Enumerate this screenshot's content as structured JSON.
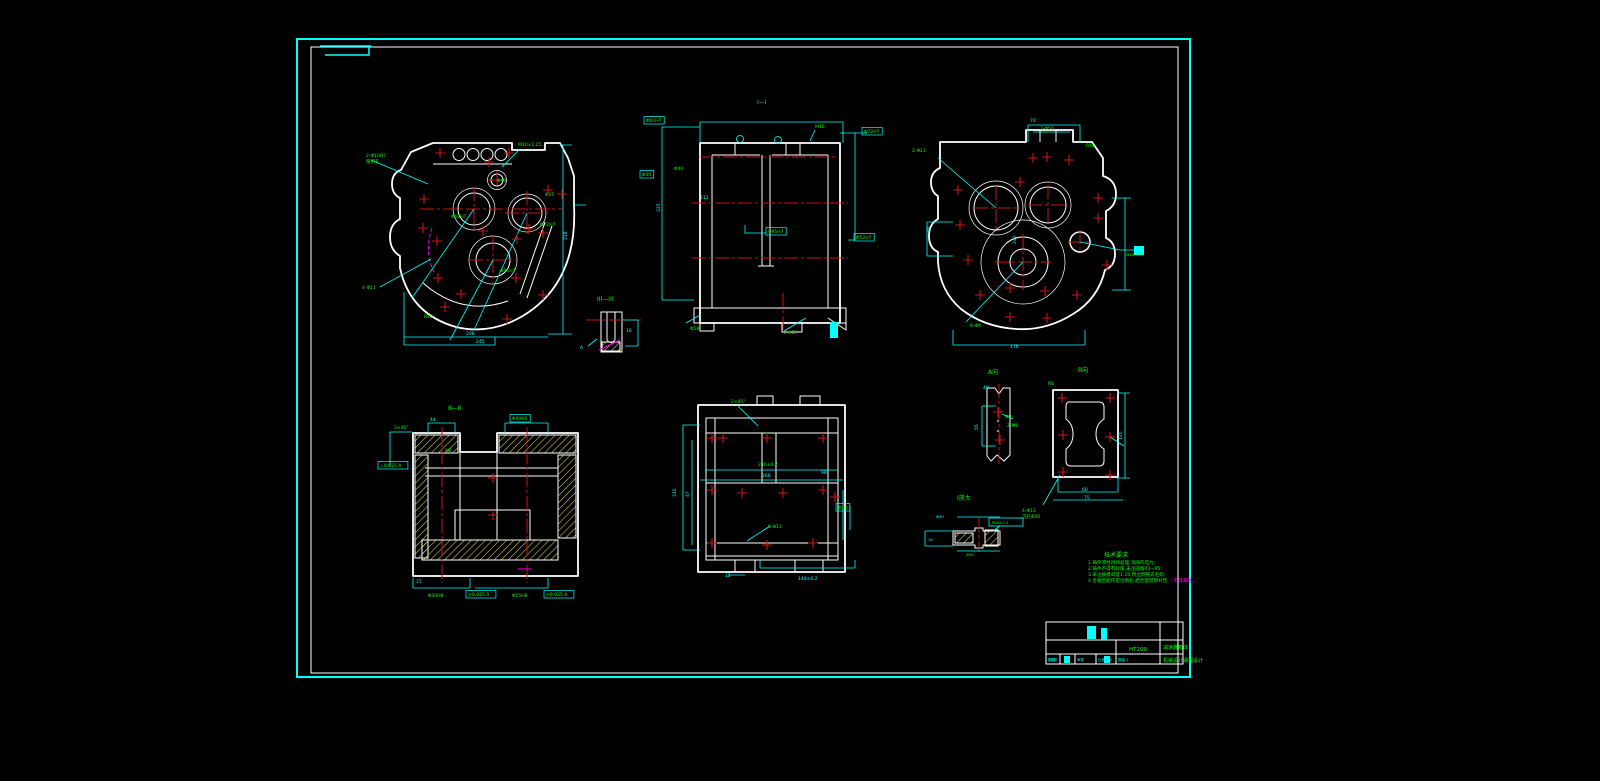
{
  "palette": {
    "background": "#000000",
    "frame_cyan": "#00ffff",
    "geometry_white": "#ffffff",
    "centerline_red": "#c81414",
    "dimension_cyan": "#00ffff",
    "label_green": "#00ff00",
    "hatch_yellow": "#ddd75a",
    "accent_magenta": "#ff00ff"
  },
  "notes": {
    "title": "技术要求",
    "items": [
      "1.铸件须经时效处理,消除内应力;",
      "2.铸件不得有砂眼,未注圆角R3~R5;",
      "3.未注拔模斜度1:20,锐边倒钝去毛刺;",
      "4.合箱后配作定位销孔,结合面禁放衬垫"
    ],
    "tail": ",不得漏油。"
  },
  "title_block": {
    "material": "HT200",
    "title": "减速器箱体",
    "subtitle": "机械设计课程设计",
    "cells": [
      "制图",
      "审核",
      "比例 1:2",
      "数量 1",
      "共1张"
    ]
  },
  "annotations": [
    {
      "x": 757,
      "y": 104,
      "t": "I—I",
      "s": 6,
      "n": "section-label"
    },
    {
      "x": 448,
      "y": 410,
      "t": "II—II",
      "s": 6,
      "n": "section-label"
    },
    {
      "x": 597,
      "y": 301,
      "t": "III—III",
      "s": 6,
      "n": "section-label"
    },
    {
      "x": 988,
      "y": 374,
      "t": "A向",
      "s": 6,
      "n": "section-label"
    },
    {
      "x": 1078,
      "y": 372,
      "t": "B向",
      "s": 6,
      "n": "section-label"
    },
    {
      "x": 957,
      "y": 500,
      "t": "I放大",
      "s": 6,
      "n": "section-label"
    },
    {
      "x": 366,
      "y": 157,
      "t": "2-Φ10H7"
    },
    {
      "x": 366,
      "y": 163,
      "t": "锥销孔"
    },
    {
      "x": 518,
      "y": 146,
      "t": "M10×1.25"
    },
    {
      "x": 497,
      "y": 182,
      "t": "Φ40"
    },
    {
      "x": 451,
      "y": 218,
      "t": "Φ62H7"
    },
    {
      "x": 540,
      "y": 226,
      "t": "Φ72H7"
    },
    {
      "x": 500,
      "y": 272,
      "t": "Φ95H7"
    },
    {
      "x": 362,
      "y": 289,
      "t": "4-Φ11"
    },
    {
      "x": 424,
      "y": 318,
      "t": "R15"
    },
    {
      "x": 466,
      "y": 335,
      "t": "206",
      "c": "c"
    },
    {
      "x": 476,
      "y": 343,
      "t": "245",
      "c": "c"
    },
    {
      "x": 567,
      "y": 240,
      "t": "218",
      "c": "c",
      "r": -90
    },
    {
      "x": 545,
      "y": 196,
      "t": "Φ25"
    },
    {
      "x": 646,
      "y": 122,
      "t": "Φ62H7",
      "b": true
    },
    {
      "x": 864,
      "y": 133,
      "t": "Φ72H7",
      "b": true
    },
    {
      "x": 674,
      "y": 170,
      "t": "Φ40"
    },
    {
      "x": 642,
      "y": 176,
      "t": "Φ30",
      "b": true
    },
    {
      "x": 700,
      "y": 199,
      "t": "112",
      "c": "c"
    },
    {
      "x": 768,
      "y": 233,
      "t": "Φ95H7",
      "b": true
    },
    {
      "x": 856,
      "y": 239,
      "t": "Φ52H7",
      "b": true
    },
    {
      "x": 690,
      "y": 330,
      "t": "Φ18"
    },
    {
      "x": 784,
      "y": 334,
      "t": "2×45°"
    },
    {
      "x": 815,
      "y": 128,
      "t": "M16"
    },
    {
      "x": 660,
      "y": 212,
      "t": "325",
      "c": "c",
      "r": -90
    },
    {
      "x": 1030,
      "y": 122,
      "t": "70",
      "c": "c"
    },
    {
      "x": 1040,
      "y": 130,
      "t": "2-Φ50"
    },
    {
      "x": 912,
      "y": 152,
      "t": "2-Φ13"
    },
    {
      "x": 1086,
      "y": 147,
      "t": "R10"
    },
    {
      "x": 930,
      "y": 232,
      "t": "98",
      "c": "c",
      "r": -90
    },
    {
      "x": 1016,
      "y": 244,
      "t": "242",
      "c": "c",
      "r": -90
    },
    {
      "x": 970,
      "y": 327,
      "t": "6-Φ9"
    },
    {
      "x": 1010,
      "y": 348,
      "t": "176",
      "c": "c"
    },
    {
      "x": 1126,
      "y": 256,
      "t": "M16×1.5",
      "s": 3.8
    },
    {
      "x": 430,
      "y": 421,
      "t": "44",
      "c": "c"
    },
    {
      "x": 512,
      "y": 420,
      "t": "Φ40K6",
      "b": true
    },
    {
      "x": 394,
      "y": 429,
      "t": "3×45°"
    },
    {
      "x": 445,
      "y": 452,
      "t": "M8"
    },
    {
      "x": 380,
      "y": 467,
      "t": "⊥0.025 A",
      "b": true
    },
    {
      "x": 428,
      "y": 597,
      "t": "Φ30H8"
    },
    {
      "x": 468,
      "y": 596,
      "t": "◎0.025 A",
      "b": true
    },
    {
      "x": 512,
      "y": 597,
      "t": "Φ25H8"
    },
    {
      "x": 546,
      "y": 596,
      "t": "◎0.025 A",
      "b": true
    },
    {
      "x": 416,
      "y": 583,
      "t": "15",
      "c": "c"
    },
    {
      "x": 731,
      "y": 403,
      "t": "2×45°"
    },
    {
      "x": 758,
      "y": 466,
      "t": "240±0.2"
    },
    {
      "x": 762,
      "y": 477,
      "t": "266",
      "c": "c"
    },
    {
      "x": 676,
      "y": 497,
      "t": "310",
      "c": "c",
      "r": -90
    },
    {
      "x": 689,
      "y": 497,
      "t": "47",
      "c": "c",
      "r": -90
    },
    {
      "x": 821,
      "y": 474,
      "t": "98",
      "c": "c"
    },
    {
      "x": 838,
      "y": 509,
      "t": "Φ18",
      "b": true
    },
    {
      "x": 768,
      "y": 528,
      "t": "6-Φ13"
    },
    {
      "x": 798,
      "y": 580,
      "t": "140±0.2",
      "c": "c"
    },
    {
      "x": 725,
      "y": 577,
      "t": "12",
      "c": "c"
    },
    {
      "x": 983,
      "y": 389,
      "t": "40",
      "c": "c"
    },
    {
      "x": 978,
      "y": 430,
      "t": "55",
      "c": "c",
      "r": -90
    },
    {
      "x": 1005,
      "y": 418,
      "t": "Φ9"
    },
    {
      "x": 1007,
      "y": 427,
      "t": "2-M6"
    },
    {
      "x": 1048,
      "y": 385,
      "t": "R8"
    },
    {
      "x": 1122,
      "y": 440,
      "t": "120",
      "c": "c",
      "r": -90
    },
    {
      "x": 1022,
      "y": 512,
      "t": "4-Φ13"
    },
    {
      "x": 1022,
      "y": 518,
      "t": "沉孔Φ20"
    },
    {
      "x": 1082,
      "y": 491,
      "t": "60",
      "c": "c"
    },
    {
      "x": 1084,
      "y": 499,
      "t": "75",
      "c": "c"
    },
    {
      "x": 936,
      "y": 518,
      "t": "Φ30",
      "c": "c",
      "s": 3.8
    },
    {
      "x": 992,
      "y": 524,
      "t": "M16×1.5",
      "s": 3.6
    },
    {
      "x": 928,
      "y": 541,
      "t": "18",
      "c": "c",
      "s": 3.8
    },
    {
      "x": 966,
      "y": 556,
      "t": "Φ30",
      "s": 3.8
    },
    {
      "x": 626,
      "y": 332,
      "t": "18",
      "c": "c"
    },
    {
      "x": 580,
      "y": 349,
      "t": "A",
      "c": "c"
    }
  ],
  "hole_markers": [
    [
      440,
      153
    ],
    [
      509,
      153
    ],
    [
      424,
      199
    ],
    [
      548,
      190
    ],
    [
      562,
      194
    ],
    [
      423,
      228
    ],
    [
      437,
      241
    ],
    [
      543,
      233
    ],
    [
      529,
      229
    ],
    [
      438,
      278
    ],
    [
      516,
      278
    ],
    [
      543,
      295
    ],
    [
      507,
      319
    ],
    [
      483,
      231
    ],
    [
      517,
      239
    ],
    [
      461,
      294
    ],
    [
      489,
      162
    ],
    [
      445,
      307
    ],
    [
      1033,
      158
    ],
    [
      1047,
      157
    ],
    [
      1069,
      160
    ],
    [
      958,
      190
    ],
    [
      1098,
      198
    ],
    [
      960,
      225
    ],
    [
      1098,
      218
    ],
    [
      968,
      260
    ],
    [
      1107,
      265
    ],
    [
      980,
      295
    ],
    [
      1077,
      295
    ],
    [
      1010,
      288
    ],
    [
      1045,
      291
    ],
    [
      1010,
      317
    ],
    [
      1047,
      318
    ],
    [
      1020,
      182
    ],
    [
      493,
      478
    ],
    [
      493,
      515
    ],
    [
      712,
      438
    ],
    [
      723,
      438
    ],
    [
      767,
      438
    ],
    [
      823,
      438
    ],
    [
      712,
      490
    ],
    [
      742,
      493
    ],
    [
      783,
      493
    ],
    [
      823,
      490
    ],
    [
      835,
      497
    ],
    [
      712,
      543
    ],
    [
      767,
      545
    ],
    [
      813,
      543
    ],
    [
      998,
      412
    ],
    [
      1000,
      440
    ],
    [
      1062,
      398
    ],
    [
      1110,
      398
    ],
    [
      1063,
      435
    ],
    [
      1110,
      437
    ],
    [
      1063,
      472
    ],
    [
      1110,
      475
    ]
  ]
}
